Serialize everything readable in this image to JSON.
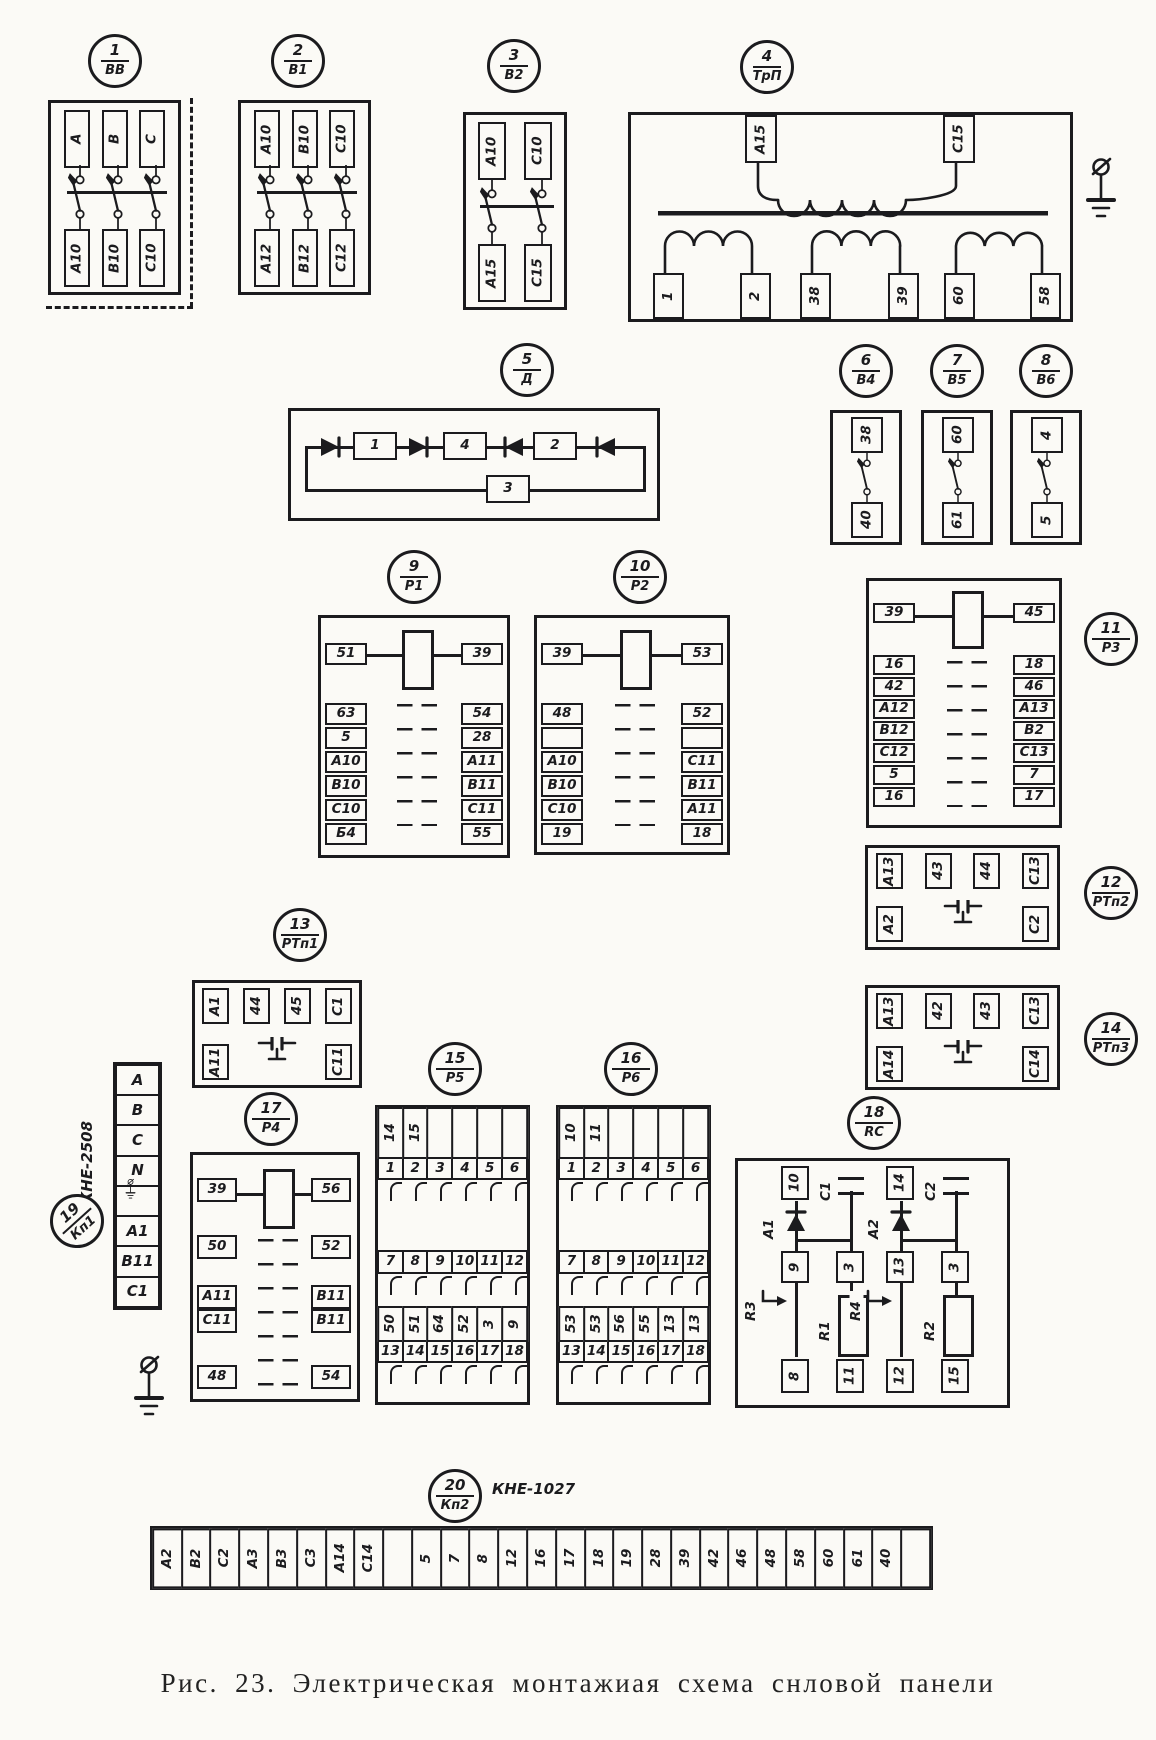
{
  "caption": "Рис. 23. Электрическая монтажиая схема снловой панели",
  "c1": {
    "num": "1",
    "tag": "ВВ",
    "top": [
      "А",
      "В",
      "С"
    ],
    "bottom": [
      "А10",
      "В10",
      "С10"
    ]
  },
  "c2": {
    "num": "2",
    "tag": "В1",
    "top": [
      "А10",
      "В10",
      "С10"
    ],
    "bottom": [
      "А12",
      "В12",
      "С12"
    ]
  },
  "c3": {
    "num": "3",
    "tag": "В2",
    "top": [
      "А10",
      "С10"
    ],
    "bottom": [
      "А15",
      "С15"
    ]
  },
  "c4": {
    "num": "4",
    "tag": "ТрП",
    "primary": [
      "А15",
      "С15"
    ],
    "secondary": [
      "1",
      "2",
      "38",
      "39",
      "60",
      "58"
    ]
  },
  "c5": {
    "num": "5",
    "tag": "Д",
    "chain": [
      "1",
      "4",
      "2"
    ],
    "branch": "3"
  },
  "c6": {
    "num": "6",
    "tag": "В4",
    "top": "38",
    "bottom": "40"
  },
  "c7": {
    "num": "7",
    "tag": "В5",
    "top": "60",
    "bottom": "61"
  },
  "c8": {
    "num": "8",
    "tag": "В6",
    "top": "4",
    "bottom": "5"
  },
  "c9": {
    "num": "9",
    "tag": "Р1",
    "left": [
      "51",
      "63",
      "5",
      "А10",
      "В10",
      "С10",
      "Б4"
    ],
    "right": [
      "39",
      "54",
      "28",
      "А11",
      "В11",
      "С11",
      "55"
    ]
  },
  "c10": {
    "num": "10",
    "tag": "Р2",
    "left": [
      "39",
      "48",
      "",
      "А10",
      "В10",
      "С10",
      "19"
    ],
    "right": [
      "53",
      "52",
      "",
      "С11",
      "В11",
      "А11",
      "18"
    ]
  },
  "c11": {
    "num": "11",
    "tag": "Р3",
    "left": [
      "39",
      "16",
      "42",
      "А12",
      "В12",
      "С12",
      "5",
      "16"
    ],
    "right": [
      "45",
      "18",
      "46",
      "А13",
      "В2",
      "С13",
      "7",
      "17"
    ]
  },
  "c12": {
    "num": "12",
    "tag": "РТп2",
    "top": [
      "А13",
      "43",
      "44",
      "С13"
    ],
    "bottom": [
      "А2",
      "С2"
    ]
  },
  "c13": {
    "num": "13",
    "tag": "РТп1",
    "top": [
      "А1",
      "44",
      "45",
      "С1"
    ],
    "bottom": [
      "А11",
      "С11"
    ]
  },
  "c14": {
    "num": "14",
    "tag": "РТп3",
    "top": [
      "А13",
      "42",
      "43",
      "С13"
    ],
    "bottom": [
      "А14",
      "С14"
    ]
  },
  "c15": {
    "num": "15",
    "tag": "Р5",
    "row0": [
      "14",
      "15",
      "",
      "",
      "",
      ""
    ],
    "row1": [
      "1",
      "2",
      "3",
      "4",
      "5",
      "6"
    ],
    "row2": [
      "7",
      "8",
      "9",
      "10",
      "11",
      "12"
    ],
    "row3": [
      "50",
      "51",
      "64",
      "52",
      "3",
      "9"
    ],
    "row4": [
      "13",
      "14",
      "15",
      "16",
      "17",
      "18"
    ]
  },
  "c16": {
    "num": "16",
    "tag": "Р6",
    "row0": [
      "10",
      "11",
      "",
      "",
      "",
      ""
    ],
    "row1": [
      "1",
      "2",
      "3",
      "4",
      "5",
      "6"
    ],
    "row2": [
      "7",
      "8",
      "9",
      "10",
      "11",
      "12"
    ],
    "row3": [
      "53",
      "53",
      "56",
      "55",
      "13",
      "13"
    ],
    "row4": [
      "13",
      "14",
      "15",
      "16",
      "17",
      "18"
    ]
  },
  "c17": {
    "num": "17",
    "tag": "Р4",
    "left": [
      "39",
      "50",
      "А11",
      "С11",
      "48"
    ],
    "right": [
      "56",
      "52",
      "В11",
      "В11",
      "54"
    ]
  },
  "c18": {
    "num": "18",
    "tag": "RC",
    "tops": [
      "10",
      "14"
    ],
    "diodes": [
      "А1",
      "А2"
    ],
    "caps": [
      "С1",
      "С2"
    ],
    "mids": [
      "9",
      "3",
      "13",
      "3"
    ],
    "arrows": [
      "R3",
      "R4"
    ],
    "resistors": [
      "R1",
      "R2"
    ],
    "bottoms": [
      "8",
      "11",
      "12",
      "15"
    ]
  },
  "c19": {
    "num": "19",
    "tag": "Кп1",
    "model": "КНЕ-2508",
    "cells": [
      "А",
      "В",
      "С",
      "N",
      "",
      "А1",
      "В11",
      "С1"
    ]
  },
  "c20": {
    "num": "20",
    "tag": "Кп2",
    "model": "КНЕ-1027",
    "cells": [
      "А2",
      "В2",
      "С2",
      "А3",
      "В3",
      "С3",
      "А14",
      "С14",
      "",
      "5",
      "7",
      "8",
      "12",
      "16",
      "17",
      "18",
      "19",
      "28",
      "39",
      "42",
      "46",
      "48",
      "58",
      "60",
      "61",
      "40",
      ""
    ]
  }
}
